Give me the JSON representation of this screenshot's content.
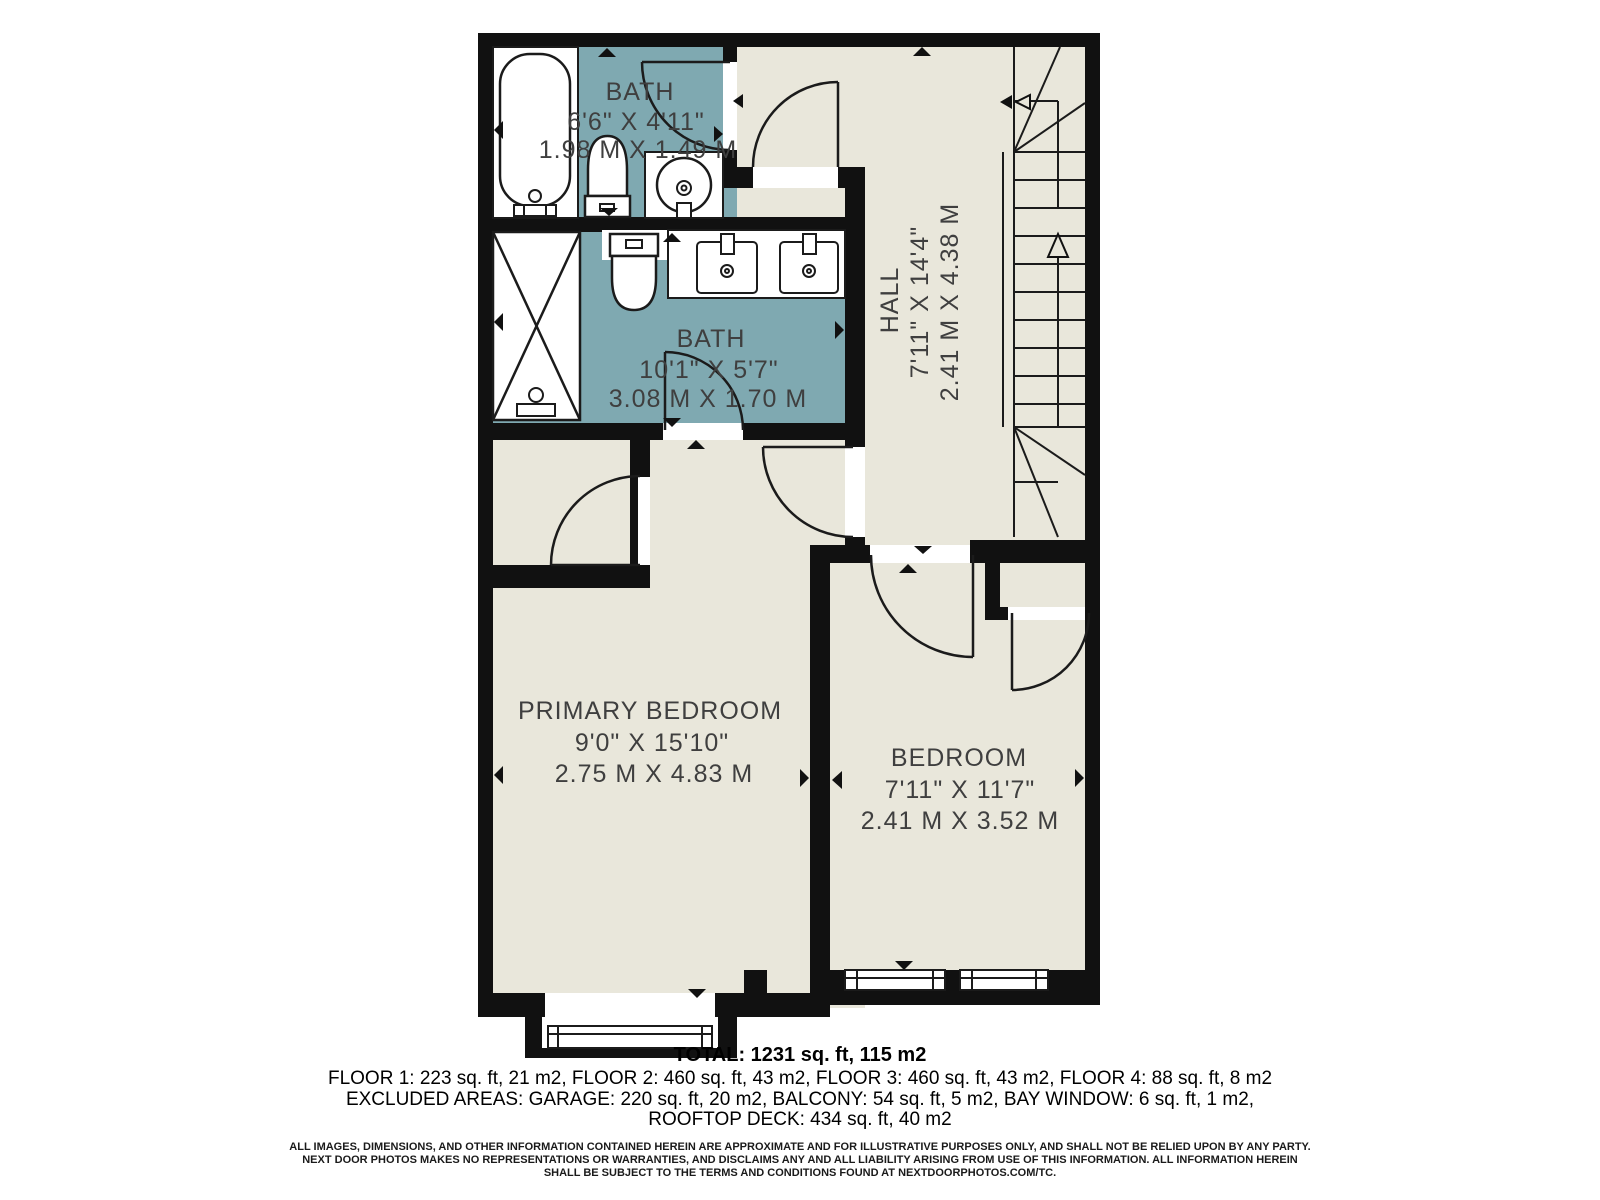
{
  "plan": {
    "rooms": {
      "bath1": {
        "name": "BATH",
        "imperial": "6'6\" X 4'11\"",
        "metric": "1.98 M X 1.49 M"
      },
      "bath2": {
        "name": "BATH",
        "imperial": "10'1\" X 5'7\"",
        "metric": "3.08 M X 1.70 M"
      },
      "hall": {
        "name": "HALL",
        "imperial": "7'11\" X 14'4\"",
        "metric": "2.41 M X 4.38 M"
      },
      "primary_bedroom": {
        "name": "PRIMARY BEDROOM",
        "imperial": "9'0\" X 15'10\"",
        "metric": "2.75 M X 4.83 M"
      },
      "bedroom": {
        "name": "BEDROOM",
        "imperial": "7'11\" X 11'7\"",
        "metric": "2.41 M X 3.52 M"
      }
    },
    "colors": {
      "floor": "#e9e7db",
      "wet_room": "#7fa9b1",
      "wall": "#111111",
      "label": "#3f3f3f"
    }
  },
  "footer": {
    "total": "TOTAL: 1231 sq. ft, 115 m2",
    "floors": "FLOOR 1: 223 sq. ft, 21 m2, FLOOR 2: 460 sq. ft, 43 m2, FLOOR 3: 460 sq. ft, 43 m2, FLOOR 4: 88 sq. ft, 8 m2",
    "excluded": "EXCLUDED AREAS: GARAGE: 220 sq. ft, 20 m2, BALCONY: 54 sq. ft, 5 m2, BAY WINDOW: 6 sq. ft, 1 m2,",
    "rooftop": "ROOFTOP DECK: 434 sq. ft, 40 m2",
    "disclaimer_line1": "ALL IMAGES, DIMENSIONS, AND OTHER INFORMATION CONTAINED HEREIN ARE APPROXIMATE AND FOR ILLUSTRATIVE PURPOSES ONLY, AND SHALL NOT BE RELIED UPON BY ANY PARTY.",
    "disclaimer_line2": "NEXT DOOR PHOTOS MAKES NO REPRESENTATIONS OR WARRANTIES, AND DISCLAIMS ANY AND ALL LIABILITY ARISING FROM USE OF THIS INFORMATION. ALL INFORMATION HEREIN",
    "disclaimer_line3": "SHALL BE SUBJECT TO THE TERMS AND CONDITIONS FOUND AT NEXTDOORPHOTOS.COM/TC."
  }
}
